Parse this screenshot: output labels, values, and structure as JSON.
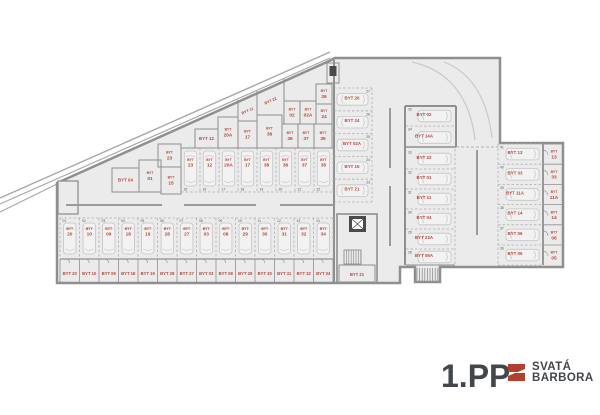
{
  "header": {
    "floor_label": "1.PP",
    "brand_line1": "SVATÁ",
    "brand_line2": "BARBORA"
  },
  "colors": {
    "wall": "#8f8f8f",
    "wall_light": "#a8a8a8",
    "floor": "#ebebeb",
    "dash": "#b0b0b0",
    "car_stroke": "#c4c4c4",
    "car_fill": "#f2f2f2",
    "unit_label": "#b5473c",
    "tiny_num": "#55585c",
    "dark_text": "#43474b",
    "brand_red": "#b2402e",
    "lane": "#9a9a9a"
  },
  "plan": {
    "unit_prefix": "BYT",
    "bottom_row": {
      "stalls": [
        {
          "no": "01",
          "unit": "20"
        },
        {
          "no": "02",
          "unit": "10"
        },
        {
          "no": "03",
          "unit": "09"
        },
        {
          "no": "04",
          "unit": "18"
        },
        {
          "no": "05",
          "unit": "19"
        },
        {
          "no": "06",
          "unit": "28"
        },
        {
          "no": "07",
          "unit": "27"
        },
        {
          "no": "08",
          "unit": "03"
        },
        {
          "no": "09",
          "unit": "08"
        },
        {
          "no": "10",
          "unit": "29"
        },
        {
          "no": "11",
          "unit": "30"
        },
        {
          "no": "12",
          "unit": "31"
        },
        {
          "no": "13",
          "unit": "32"
        },
        {
          "no": "14",
          "unit": "34"
        }
      ],
      "storage": [
        "20",
        "10",
        "09",
        "18",
        "19",
        "28",
        "27",
        "03",
        "08",
        "29",
        "30",
        "31",
        "32",
        "34"
      ]
    },
    "upper_row": {
      "stalls": [
        {
          "no": "15",
          "unit": "23"
        },
        {
          "no": "16",
          "unit": "12"
        },
        {
          "no": "17",
          "unit": "20A"
        },
        {
          "no": "18",
          "unit": "17"
        },
        {
          "no": "19",
          "unit": "38"
        },
        {
          "no": "20",
          "unit": "36"
        },
        {
          "no": "21",
          "unit": "37"
        },
        {
          "no": "22",
          "unit": "35"
        }
      ]
    },
    "mid_column": {
      "stalls": [
        {
          "no": "27",
          "unit": "26"
        },
        {
          "no": "26",
          "unit": "24"
        },
        {
          "no": "25",
          "unit": "02A"
        },
        {
          "no": "24",
          "unit": "15"
        },
        {
          "no": "23",
          "unit": "21"
        }
      ]
    },
    "right_mid_column": {
      "stalls": [
        {
          "no": "35",
          "unit": "02"
        },
        {
          "no": "34",
          "unit": "14A"
        },
        {
          "no": "33",
          "unit": "22"
        },
        {
          "no": "32",
          "unit": "01"
        },
        {
          "no": "31",
          "unit": "11"
        },
        {
          "no": "30",
          "unit": "04"
        },
        {
          "no": "29",
          "unit": "23A"
        },
        {
          "no": "28",
          "unit": "05A"
        }
      ]
    },
    "right_column": {
      "stalls": [
        {
          "no": "41",
          "unit": "13"
        },
        {
          "no": "40",
          "unit": "33"
        },
        {
          "no": "39",
          "unit": "11A"
        },
        {
          "no": "38",
          "unit": "14"
        },
        {
          "no": "37",
          "unit": "06"
        },
        {
          "no": "36",
          "unit": "05"
        }
      ],
      "storage": [
        "13",
        "33",
        "11A",
        "14",
        "06",
        "05"
      ]
    },
    "triangle_storage": [
      {
        "unit": "04",
        "lines": 1
      },
      {
        "unit": "01",
        "lines": 2
      },
      {
        "unit": "15",
        "lines": 2
      },
      {
        "unit": "23",
        "lines": 2
      },
      {
        "unit": "12",
        "lines": 1
      },
      {
        "unit": "20A",
        "lines": 2
      },
      {
        "unit": "17",
        "lines": 2
      },
      {
        "unit": "38",
        "lines": 2
      },
      {
        "unit": "36",
        "lines": 2
      },
      {
        "unit": "37",
        "lines": 2
      },
      {
        "unit": "35",
        "lines": 2
      },
      {
        "unit": "02",
        "lines": 2
      },
      {
        "unit": "02A",
        "lines": 2
      },
      {
        "unit": "24",
        "lines": 2
      },
      {
        "unit": "26",
        "lines": 2
      }
    ],
    "rotated_storage": [
      {
        "unit": "11"
      },
      {
        "unit": "22"
      }
    ],
    "core_storage": "21"
  }
}
